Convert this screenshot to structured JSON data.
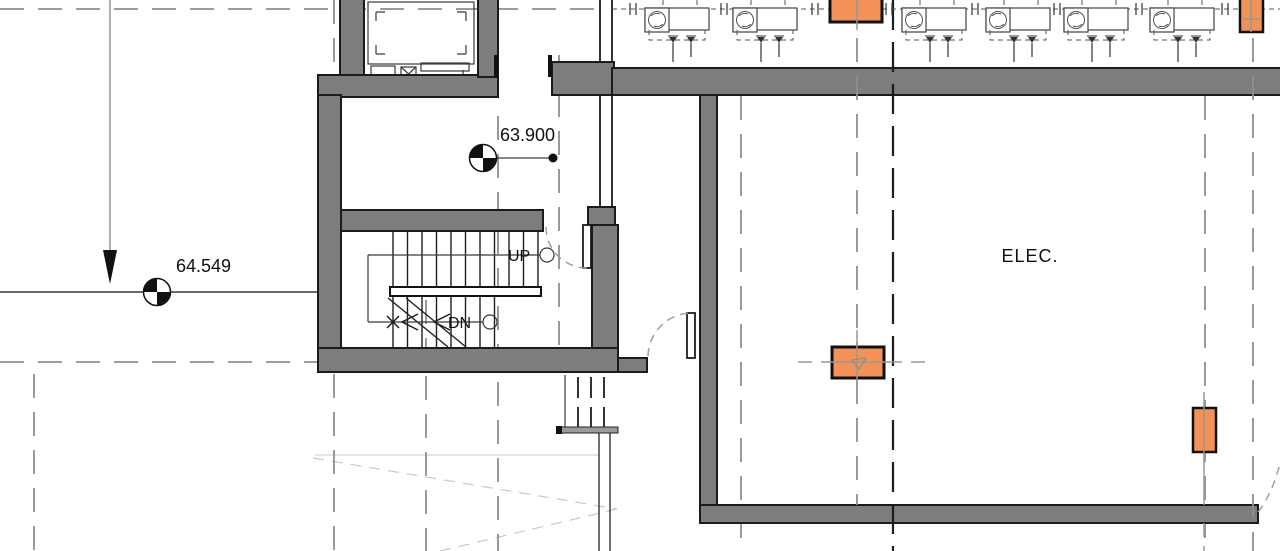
{
  "plan": {
    "room_labels": [
      {
        "name": "ELEC."
      }
    ],
    "stair": {
      "up_label": "UP",
      "down_label": "DN"
    },
    "spot_elevations": [
      {
        "value": "63.900"
      },
      {
        "value": "64.549"
      }
    ],
    "colors": {
      "wall_gray": "#7D7D7D",
      "equipment_orange": "#F29258",
      "line_black": "#1B1B1B",
      "centerline_gray": "#989898"
    },
    "icons": {
      "spot_elevation_marker": "spot-elevation-marker-icon",
      "fan_coil_unit": "fan-coil-unit-icon",
      "equipment_box": "equipment-box-orange",
      "door_swing": "door-swing-arc-icon",
      "section_arrow": "down-arrow-icon",
      "stair_run_terminator": "stair-run-circle-icon"
    }
  }
}
